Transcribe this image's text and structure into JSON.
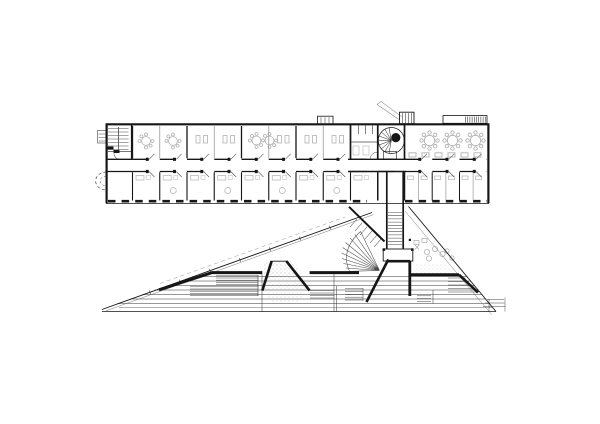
{
  "meta": {
    "title": "Architectural floor plan",
    "drawing_type": "line drawing — linear office bar building over a triangular stepped plaza/amphitheatre",
    "visible_text": "none"
  },
  "colors": {
    "background": "#ffffff",
    "ink": "#161616",
    "medium": "#4a4a4a",
    "detail_gray": "#777777",
    "light_gray": "#999999",
    "furniture": "#b2b2b2",
    "terrace": "#303030",
    "stipple": "#8a8a8a"
  },
  "inventory": {
    "bar_building": {
      "top_room_modules": 9,
      "bottom_room_modules": 15,
      "central_corridor": true,
      "left_dogleg_stair": true,
      "spiral_stair_with_shaft": true,
      "wc_block": true,
      "open_workroom_tables": 3,
      "roof_canopy_hatched": true,
      "roof_stack": true
    },
    "connector": {
      "vertical_link_with_ladder_stair": true,
      "fan_ramp_hatch": true,
      "seat_room_x_symbols": 2
    },
    "plaza": {
      "left_edge_diagonal": true,
      "right_edge_diagonal": true,
      "terrace_step_lines": 7,
      "retaining_wall_segments": 6,
      "stair_trapezoid_with_stipple": 1,
      "stair_runs": 6
    }
  }
}
